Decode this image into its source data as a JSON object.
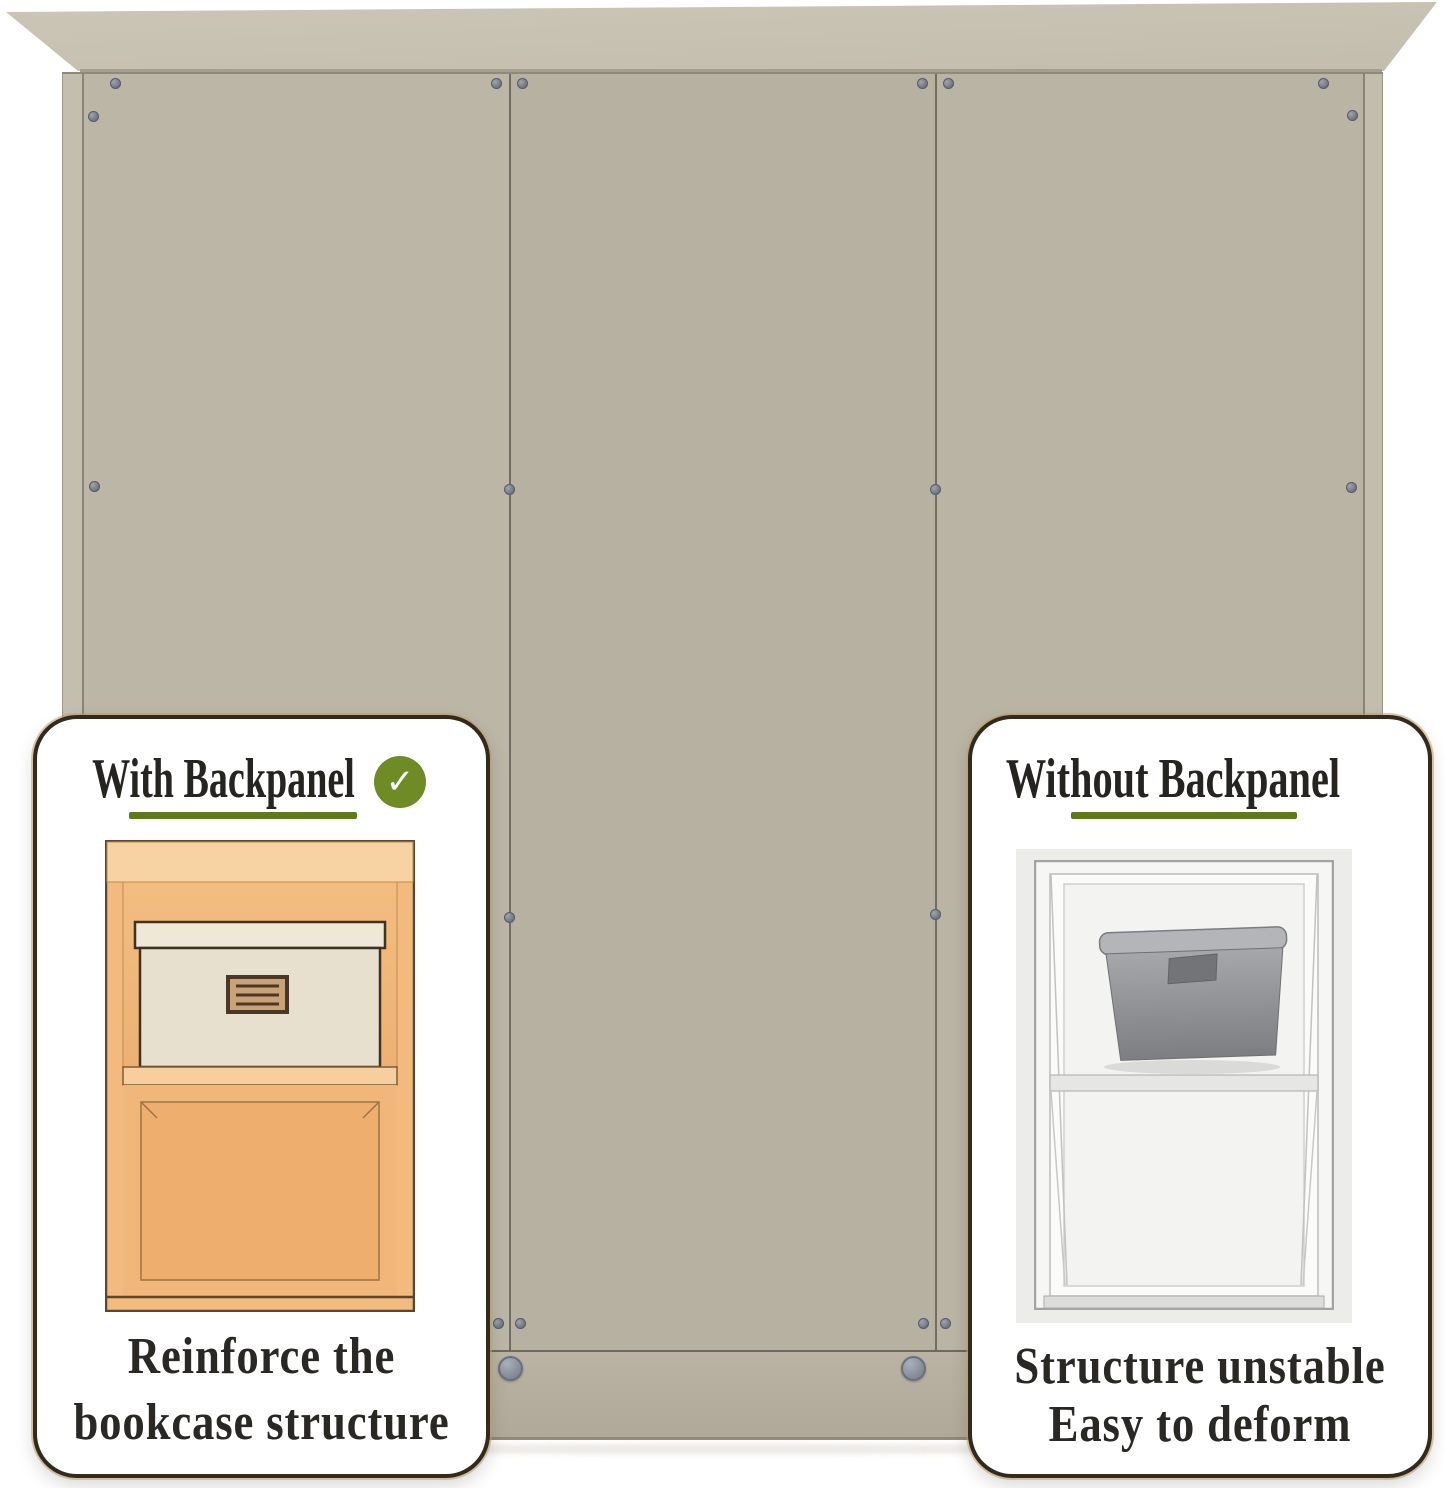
{
  "comparison": {
    "left_card": {
      "title": "With Backpanel",
      "check_icon": "✓",
      "caption_line1": "Reinforce the",
      "caption_line2": "bookcase structure"
    },
    "right_card": {
      "title": "Without Backpanel",
      "caption_line1": "Structure unstable",
      "caption_line2": "Easy to deform"
    }
  },
  "colors": {
    "accent_underline_green": "#5e7a1c",
    "check_circle_green": "#6f8b26",
    "card_border_brown": "#33291d",
    "panel_greige": "#b7b1a2",
    "crown_greige": "#c6c0b2",
    "wood_orange": "#f2ba7e",
    "storage_box_gray": "#9fa0a3",
    "screw_gray": "#787d87"
  }
}
